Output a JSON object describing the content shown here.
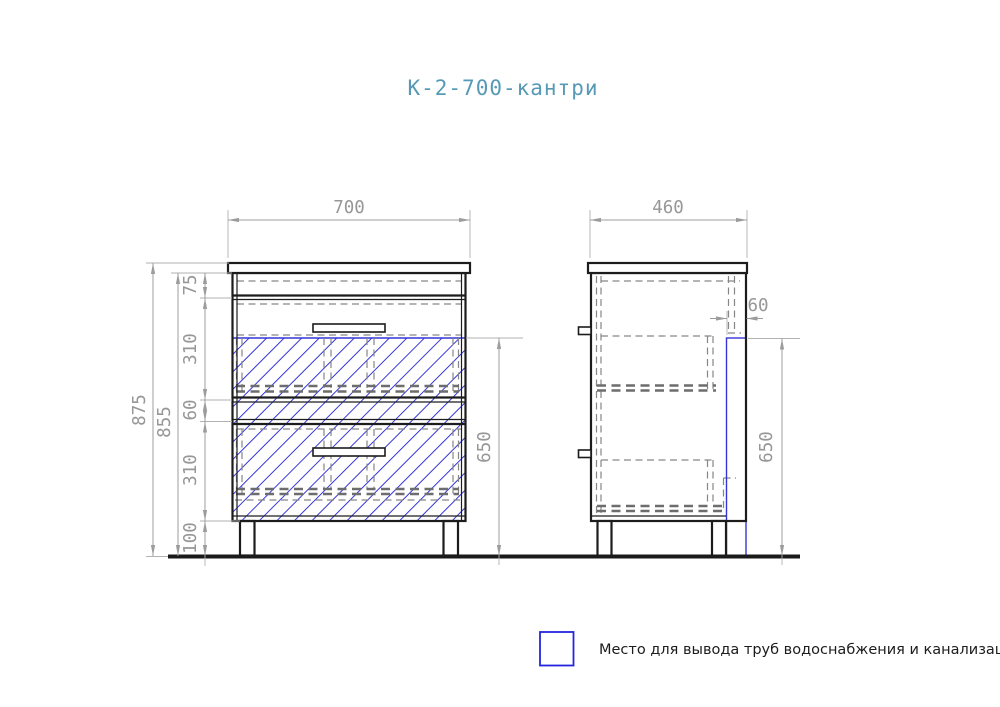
{
  "title": "К-2-700-кантри",
  "front_view": {
    "width_mm": "700",
    "total_height_mm": "875",
    "cabinet_height_mm": "855",
    "top_section_mm": "75",
    "upper_drawer_mm": "310",
    "drawer_gap_mm": "60",
    "lower_drawer_mm": "310",
    "leg_height_mm": "100",
    "pipe_zone_height_mm": "650"
  },
  "side_view": {
    "depth_mm": "460",
    "pipe_zone_depth_mm": "60",
    "pipe_zone_height_mm": "650"
  },
  "legend": {
    "label": "Место для вывода труб водоснабжения и канализации"
  },
  "colors": {
    "title_text": "#579ab6",
    "dimension_text": "#979797",
    "drawing_line": "#1c1c1c",
    "hatch_blue": "#3535d8"
  }
}
